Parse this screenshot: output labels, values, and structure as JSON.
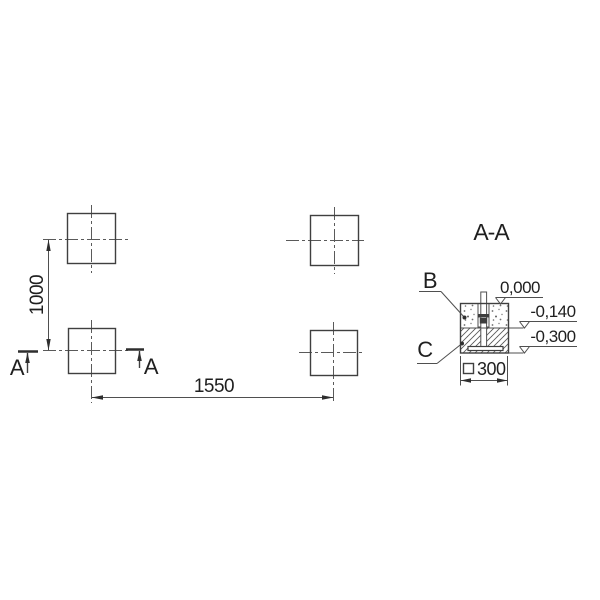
{
  "plan": {
    "dim_vertical": "1000",
    "dim_horizontal": "1550",
    "cut_left_letter": "A",
    "cut_right_letter": "A"
  },
  "section": {
    "title": "A-A",
    "label_b": "B",
    "label_c": "C",
    "levels": {
      "top": "0,000",
      "middle": "-0,140",
      "bottom": "-0,300"
    },
    "base_dimension": "300",
    "square_symbol": "□"
  },
  "colors": {
    "line": "#4f4f4f",
    "text": "#1f1f1f",
    "background": "#ffffff"
  }
}
